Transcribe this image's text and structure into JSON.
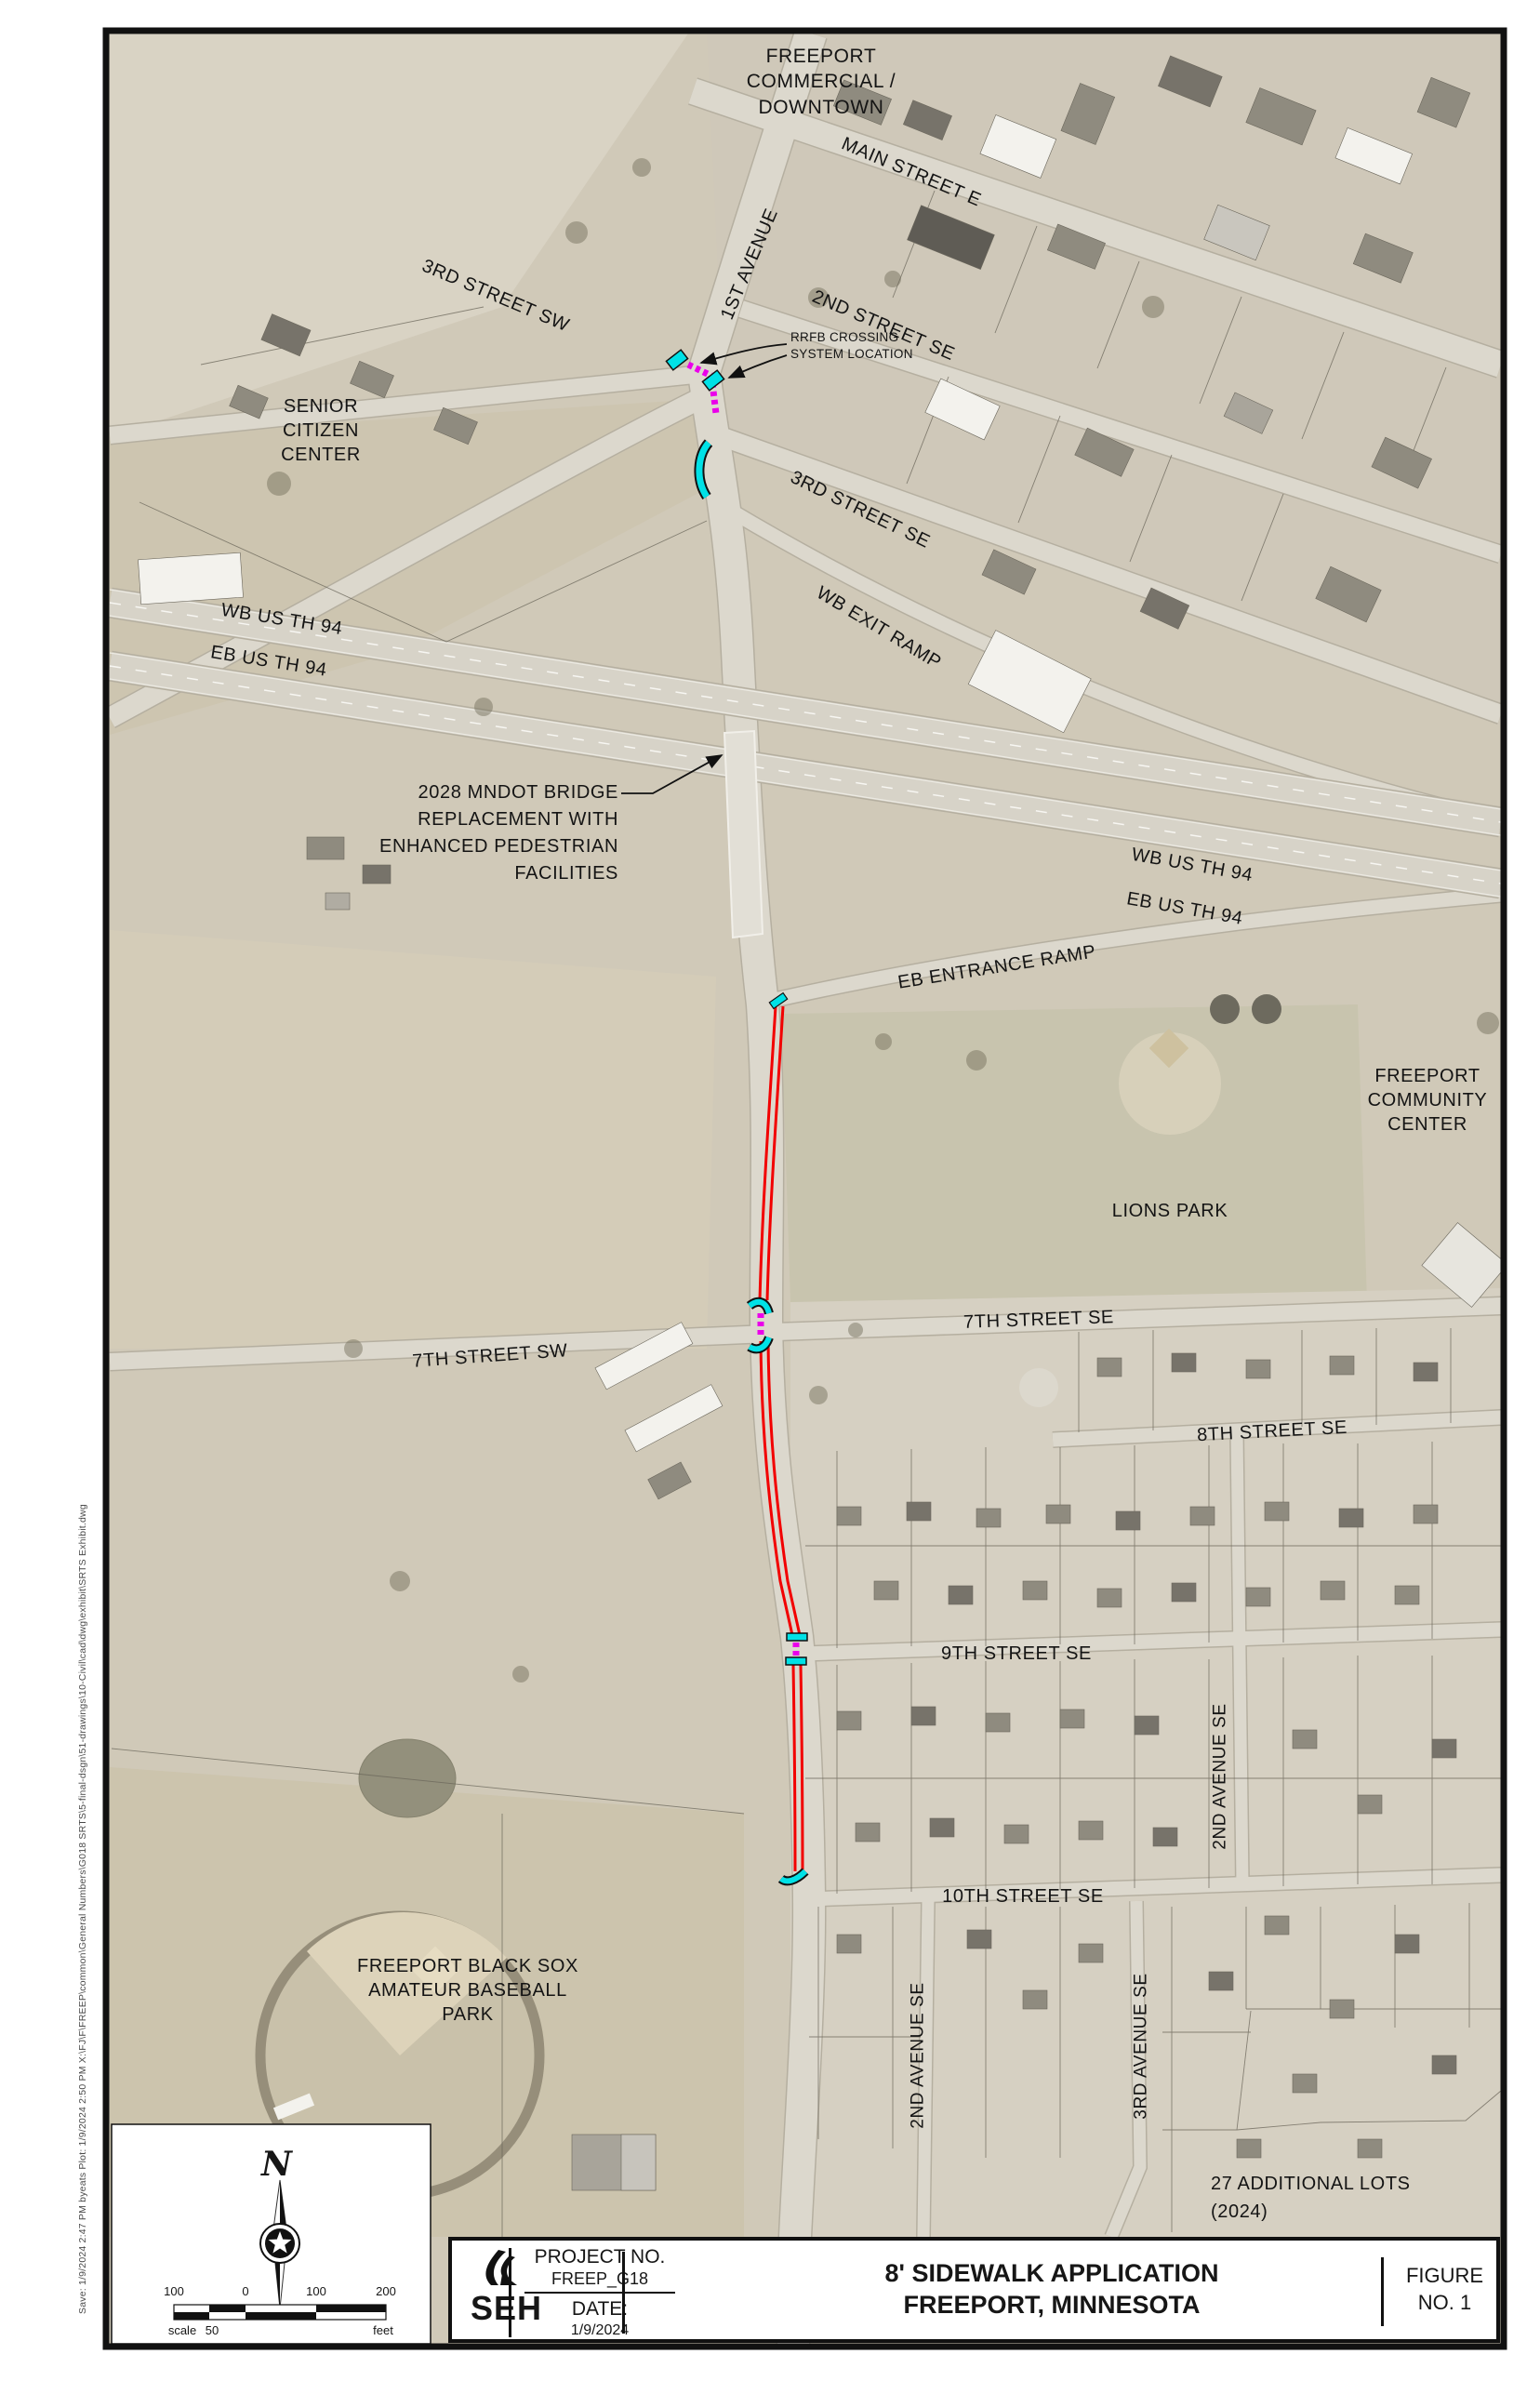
{
  "map": {
    "area_labels": {
      "downtown": "FREEPORT\nCOMMERCIAL /\nDOWNTOWN",
      "senior_center": "SENIOR\nCITIZEN\nCENTER",
      "community_center": "FREEPORT\nCOMMUNITY\nCENTER",
      "lions_park": "LIONS PARK",
      "black_sox": "FREEPORT BLACK SOX\nAMATEUR BASEBALL\nPARK",
      "additional_lots": "27 ADDITIONAL LOTS\n(2024)"
    },
    "street_labels": {
      "main_street_e": "MAIN STREET E",
      "first_avenue": "1ST AVENUE",
      "second_street_se": "2ND STREET SE",
      "third_street_sw": "3RD STREET SW",
      "third_street_se": "3RD STREET SE",
      "wb_exit_ramp": "WB EXIT RAMP",
      "eb_entrance_ramp": "EB ENTRANCE RAMP",
      "wb_us_th_94_west": "WB US TH 94",
      "eb_us_th_94_west": "EB US TH 94",
      "wb_us_th_94_east": "WB US TH 94",
      "eb_us_th_94_east": "EB US TH 94",
      "seventh_street_sw": "7TH STREET SW",
      "seventh_street_se": "7TH STREET SE",
      "eighth_street_se": "8TH STREET SE",
      "ninth_street_se": "9TH STREET SE",
      "tenth_street_se": "10TH STREET SE",
      "second_avenue_se_north": "2ND AVENUE SE",
      "second_avenue_se_south": "2ND AVENUE SE",
      "third_avenue_se": "3RD AVENUE SE"
    },
    "callouts": {
      "rrfb": "RRFB CROSSING\nSYSTEM LOCATION",
      "mndot_bridge": "2028 MNDOT BRIDGE\nREPLACEMENT WITH\nENHANCED PEDESTRIAN\nFACILITIES"
    },
    "north_letter": "N",
    "scale_bar": {
      "tick_100_left": "100",
      "tick_0": "0",
      "tick_100_right": "100",
      "tick_200": "200",
      "scale_word": "scale",
      "fifty": "50",
      "unit": "feet"
    }
  },
  "title_block": {
    "logo": "SEH",
    "project_no_label": "PROJECT NO.",
    "project_no": "FREEP_G18",
    "date_label": "DATE:",
    "date_value": "1/9/2024",
    "title_line1": "8' SIDEWALK APPLICATION",
    "title_line2": "FREEPORT, MINNESOTA",
    "figure_label": "FIGURE",
    "figure_no": "NO. 1"
  },
  "plot_stamp": "Save: 1/9/2024 2:47 PM  byeats   Plot: 1/9/2024 2:50 PM   X:\\FJ\\F\\FREEP\\common\\General Numbers\\G018 SRTS\\5-final-dsgn\\51-drawings\\10-Civil\\cad\\dwg\\exhibit\\SRTS Exhibit.dwg",
  "colors": {
    "proposed_sidewalk_red": "#f20000",
    "ped_ramp_cyan": "#00e1e6",
    "crosswalk_magenta": "#ea00ea"
  }
}
